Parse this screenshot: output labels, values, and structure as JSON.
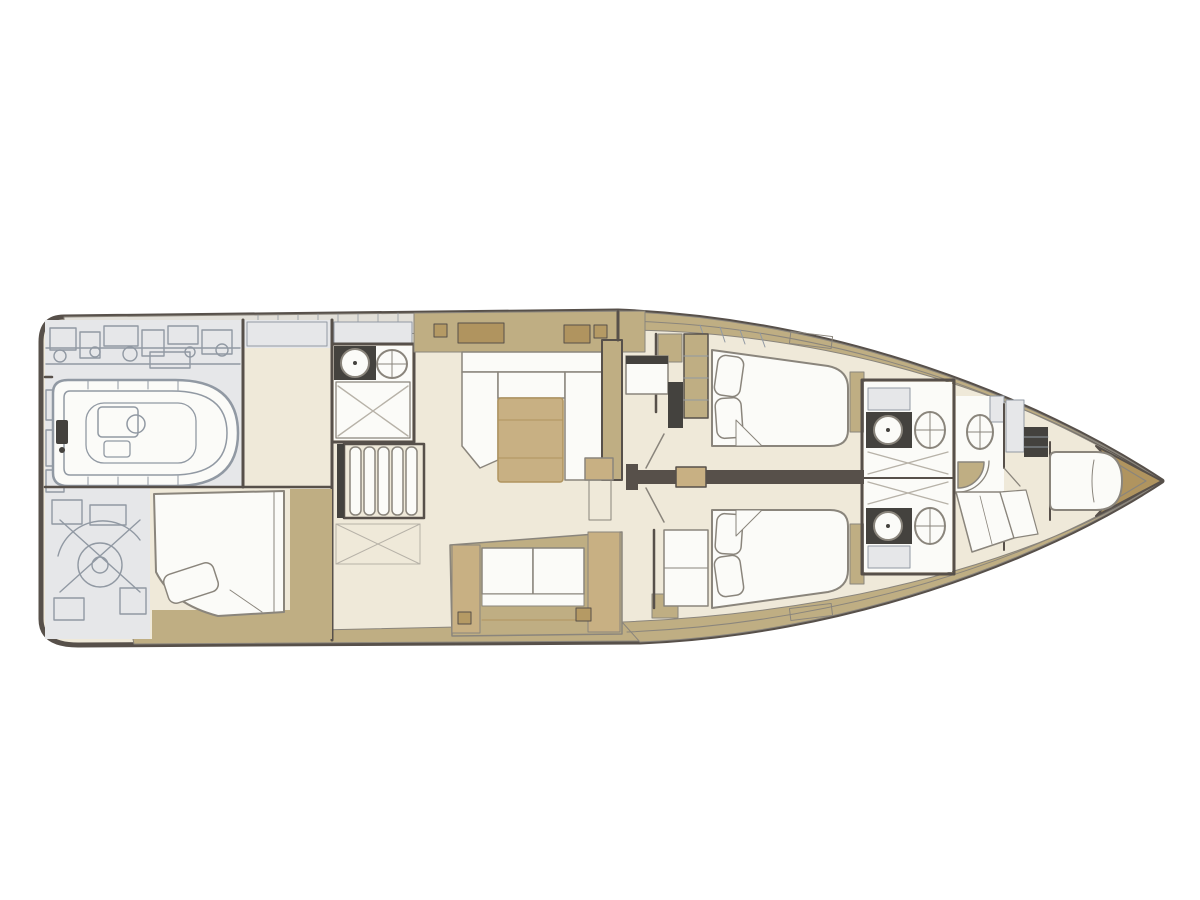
{
  "figure": {
    "type": "deck-plan-diagram",
    "subject": "sailing-yacht-interior-layout",
    "orientation": "bow-right",
    "aria_label": "Sailing yacht interior deck plan viewed from above, bow pointing right"
  },
  "rooms": [
    "tender-garage",
    "lazarette-machinery",
    "aft-cabin",
    "aft-head",
    "companionway-stairs",
    "galley",
    "salon",
    "corridor",
    "guest-cabin-port",
    "guest-cabin-starboard",
    "head-port",
    "head-starboard",
    "forward-head",
    "forward-cabin",
    "anchor-locker"
  ],
  "palette": {
    "background": "#ffffff",
    "hull_outline": "#57504a",
    "deck_tan": "#bfae83",
    "furniture_tan": "#c8b083",
    "furniture_tan_dark": "#b0945f",
    "floor_cream": "#efe9d9",
    "white_surface": "#fbfbf8",
    "outline_grey": "#8a857c",
    "technical_grey": "#e6e7e9",
    "technical_line": "#9199a3",
    "band_grey": "#e2dfd8",
    "shower_line": "#b7b2a8",
    "dark_fixture": "#44423e",
    "gold_accent": "#b59a64"
  }
}
